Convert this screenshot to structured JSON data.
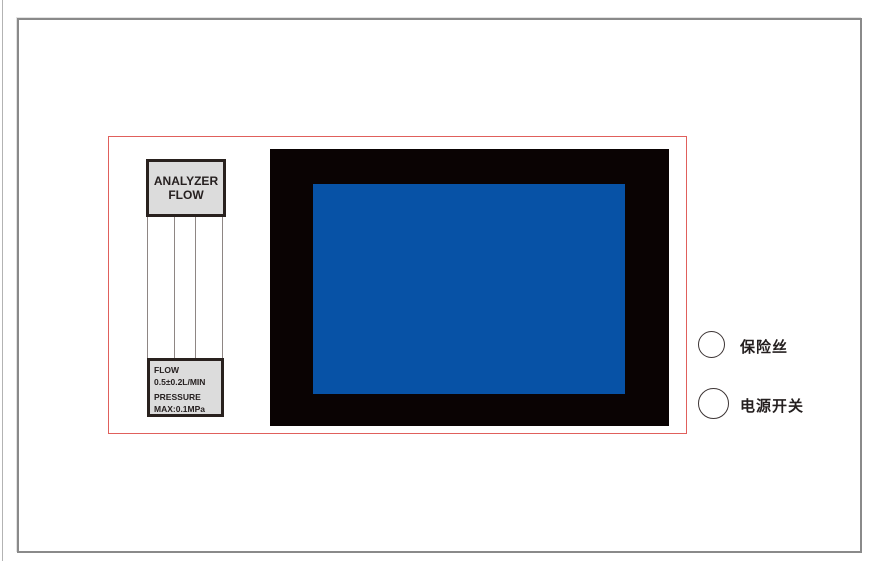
{
  "colors": {
    "outline_red": "#e0605c",
    "label_border": "#29211e",
    "label_bg": "#dcdcdc",
    "tube_line": "#8e8684",
    "bezel_black": "#0a0303",
    "screen_blue": "#0752a6",
    "panel_border": "#8a8a8a",
    "edge_line": "#b3b3b3",
    "text_dark": "#262020"
  },
  "flowmeter": {
    "top_label": {
      "line1": "ANALYZER",
      "line2": "FLOW"
    },
    "spec_label": {
      "line1": "FLOW",
      "line2": "0.5±0.2L/MIN",
      "line3": "PRESSURE",
      "line4": "MAX:0.1MPa"
    }
  },
  "controls": {
    "fuse": {
      "label": "保险丝"
    },
    "power": {
      "label": "电源开关"
    }
  }
}
